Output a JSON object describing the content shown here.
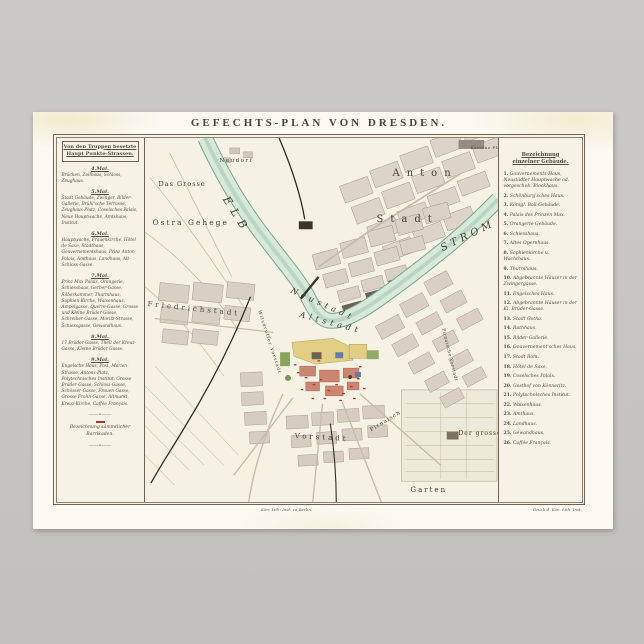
{
  "scene": {
    "background_color": "#c8c6c3",
    "poster_color": "#fbf9f2"
  },
  "title": "GEFECHTS-PLAN VON DRESDEN.",
  "left_legend": {
    "header_line1": "Von den Truppen besetzte",
    "header_line2": "Haupt Punkte-Strassen.",
    "sections": [
      {
        "date": "4.Mai.",
        "text": "Brücken, Zollhaus, Schloss, Zeughaus."
      },
      {
        "date": "5.Mai.",
        "text": "Stadt Gebäude, Zwinger, Bilder-Gallerie, Brühl'sche Terrasse, Zeughaus-Platz, Coselsches Palais, Neue Hauptwache, Amtshaus, Institut."
      },
      {
        "date": "6.Mai.",
        "text": "Hauptwache, Frauenkirche, Hôtel de Saxe, Stadthaus, Gouvernementshaus, Prinz Anton Palais, Amthaus, Landhaus, Alt-Schloss-Gasse."
      },
      {
        "date": "7.Mai.",
        "text": "Prinz Max Palais, Orangerie, Schiesshaus, Gerber-Gasse, Silberkammer, Thurmhaus, Sophien-Kirche, Waisenhaus, Ampelgasse, Querre-Gasse, Grosse und Kleine Brüder-Gasse, Schreiber-Gasse, Moritz-Strasse, Schiessgasse, Gewandhaus."
      },
      {
        "date": "8.Mai.",
        "text": "17 Brüder-Gasse, Theil der Kreuz-Gasse, Kleine Brüder-Gasse."
      },
      {
        "date": "9.Mai.",
        "text": "Engelsche Haus, Post, Marien-Strasse, Antons-Platz, Polytechnisches Institut, Grosse Brüder-Gasse, Schloss-Gasse, Schösser-Gasse, Frauen-Gasse, Grosse Frohn-Gasse, Altmarkt, Kreuz-Kirche, Caffée Français."
      }
    ],
    "barricade_note": "Bezeichnung sämmtlicher Barrikaden."
  },
  "right_legend": {
    "header_line1": "Bezeichnung",
    "header_line2": "einzelner Gebäude.",
    "items": [
      {
        "num": "1.",
        "label": "Gouvernements-Haus, Neustädter Hauptwache od. vorgeschob. Blockhaus."
      },
      {
        "num": "2.",
        "label": "Schönburg'sches Haus."
      },
      {
        "num": "3.",
        "label": "Königl. Ball-Gebäude."
      },
      {
        "num": "4.",
        "label": "Palais des Prinzen Max."
      },
      {
        "num": "5.",
        "label": "Orangerie-Gebäude."
      },
      {
        "num": "6.",
        "label": "Schiesshaus."
      },
      {
        "num": "7.",
        "label": "Altes Opernhaus."
      },
      {
        "num": "8.",
        "label": "Sophienkirche u. Wachthaus."
      },
      {
        "num": "9.",
        "label": "Thurmhaus."
      },
      {
        "num": "10.",
        "label": "Abgebrannte Häuser in der Zwingergasse."
      },
      {
        "num": "11.",
        "label": "Engelsches Haus."
      },
      {
        "num": "12.",
        "label": "Abgebrannte Häuser in der Kl. Brüder-Gasse."
      },
      {
        "num": "13.",
        "label": "Stadt Gotha."
      },
      {
        "num": "14.",
        "label": "Rathhaus."
      },
      {
        "num": "15.",
        "label": "Bilder-Gallerie."
      },
      {
        "num": "16.",
        "label": "Gouvernement'sches Haus."
      },
      {
        "num": "17.",
        "label": "Stadt Rom."
      },
      {
        "num": "18.",
        "label": "Hôtel de Saxe."
      },
      {
        "num": "19.",
        "label": "Coselsches Palais."
      },
      {
        "num": "20.",
        "label": "Gasthof von Könneritz."
      },
      {
        "num": "21.",
        "label": "Polytechnisches Institut."
      },
      {
        "num": "22.",
        "label": "Waisenhaus."
      },
      {
        "num": "23.",
        "label": "Amthaus."
      },
      {
        "num": "24.",
        "label": "Landhaus."
      },
      {
        "num": "25.",
        "label": "Gewandhaus."
      },
      {
        "num": "26.",
        "label": "Caffée Français."
      }
    ]
  },
  "map": {
    "labels": [
      "Neudorf",
      "Das Grosse",
      "Ostra Gehege",
      "ELB",
      "STROM",
      "Anton",
      "Stadt",
      "Kaserne Platz",
      "Neustadt",
      "Altstadt",
      "Friedrichstadt",
      "Wilsdruffer Vorstadt",
      "Vorstadt",
      "Pirnaisch",
      "Pirnaische Vorstadt",
      "Der grosse",
      "Garten"
    ],
    "captions": {
      "left": "Kön: Lith: Inst: zu Berlin.",
      "right": "Druck d. Kön. Lith. Inst."
    },
    "colors": {
      "paper": "#f6f2e5",
      "river_fill": "#d8e8db",
      "river_edge": "#76a78f",
      "block_gray": "#d9d1c4",
      "building_dark": "#6a6158",
      "barricade_red": "#b13226",
      "accent_yellow": "#e3cf84",
      "accent_red": "#cc8473",
      "accent_green": "#8aa35e",
      "accent_blue": "#5f7ca6"
    }
  }
}
